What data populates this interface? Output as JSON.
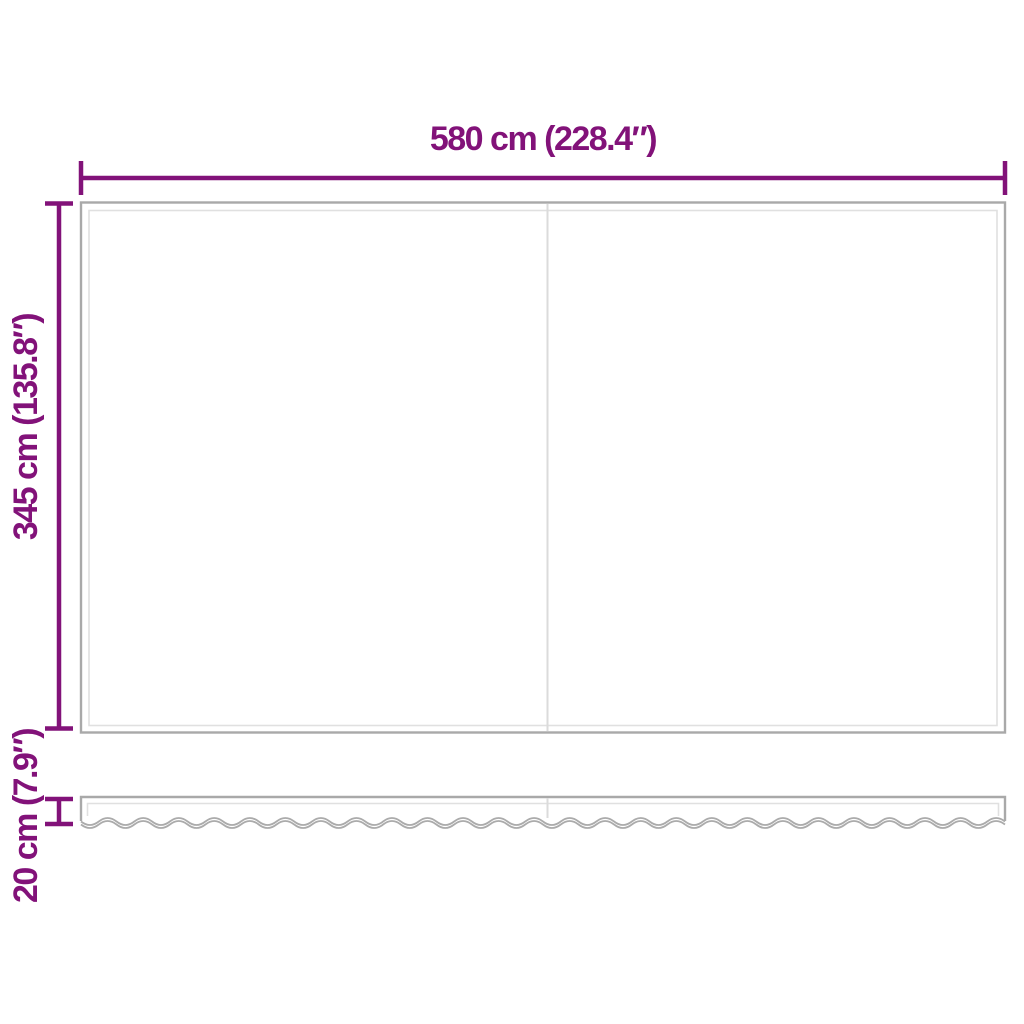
{
  "diagram": {
    "labels": {
      "width": "580 cm (228.4″)",
      "height": "345 cm (135.8″)",
      "valance_height": "20 cm (7.9″)"
    },
    "colors": {
      "dimension": "#821279",
      "fabric_outline": "#a9a9a9",
      "fabric_inner_hem": "#e0e0e0",
      "fabric_seam": "#dbdbdb",
      "wave_edge": "#ababab",
      "background": "#ffffff"
    }
  }
}
